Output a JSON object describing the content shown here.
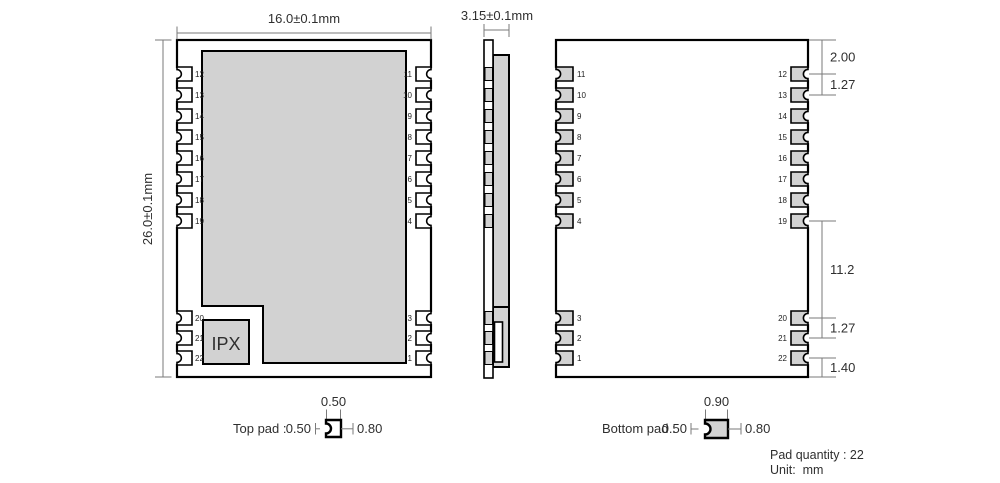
{
  "colors": {
    "module_fill": "#d2d2d2",
    "pad_fill_top_view": "#ffffff",
    "pad_fill_bottom_view": "#d2d2d2",
    "outline": "#000000",
    "dim_line": "#7a7a7a",
    "text": "#2f2f2f"
  },
  "top_view": {
    "width_dim": "16.0±0.1mm",
    "height_dim": "26.0±0.1mm",
    "ipx_label": "IPX",
    "left_pad_numbers": [
      "12",
      "13",
      "14",
      "15",
      "16",
      "17",
      "18",
      "19",
      "20",
      "21",
      "22"
    ],
    "right_pad_numbers": [
      "11",
      "10",
      "9",
      "8",
      "7",
      "6",
      "5",
      "4",
      "3",
      "2",
      "1"
    ]
  },
  "side_view": {
    "thickness_dim": "3.15±0.1mm"
  },
  "bottom_view": {
    "left_pad_numbers": [
      "11",
      "10",
      "9",
      "8",
      "7",
      "6",
      "5",
      "4",
      "3",
      "2",
      "1"
    ],
    "right_pad_numbers": [
      "12",
      "13",
      "14",
      "15",
      "16",
      "17",
      "18",
      "19",
      "20",
      "21",
      "22"
    ],
    "dimensions": [
      {
        "label": "2.00",
        "from": "top-edge",
        "to": "pad-12-center"
      },
      {
        "label": "1.27",
        "from": "pad-12-center",
        "to": "pad-13-center"
      },
      {
        "label": "11.2",
        "from": "pad-19-center",
        "to": "pad-20-center"
      },
      {
        "label": "1.27",
        "from": "pad-20-center",
        "to": "pad-21-center"
      },
      {
        "label": "1.40",
        "from": "pad-22-center",
        "to": "bottom-edge"
      }
    ]
  },
  "pad_details": {
    "top_pad": {
      "label": "Top pad :",
      "width_dim": "0.50",
      "notch_dim": "0.50",
      "length_dim": "0.80"
    },
    "bottom_pad": {
      "label": "Bottom pad :",
      "width_dim": "0.90",
      "notch_dim": "0.50",
      "length_dim": "0.80"
    }
  },
  "footer": {
    "pad_quantity": "Pad quantity : 22",
    "unit": "Unit:  mm"
  }
}
